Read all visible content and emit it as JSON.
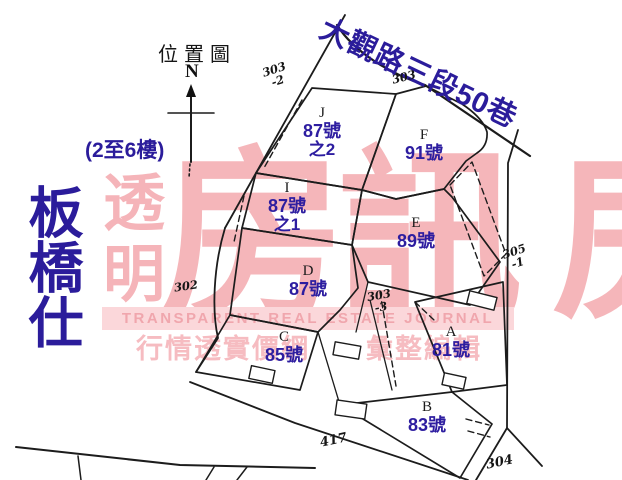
{
  "page": {
    "title": "位置圖",
    "floor_note": "(2至6樓)",
    "area_label": "板橋仕",
    "street_name": "大觀路三段50巷"
  },
  "compass": {
    "north_label": "N"
  },
  "parcels": [
    {
      "letter": "J",
      "number": "87號",
      "suffix": "之2"
    },
    {
      "letter": "F",
      "number": "91號",
      "suffix": ""
    },
    {
      "letter": "I",
      "number": "87號",
      "suffix": "之1"
    },
    {
      "letter": "E",
      "number": "89號",
      "suffix": ""
    },
    {
      "letter": "D",
      "number": "87號",
      "suffix": ""
    },
    {
      "letter": "C",
      "number": "85號",
      "suffix": ""
    },
    {
      "letter": "A",
      "number": "81號",
      "suffix": ""
    },
    {
      "letter": "B",
      "number": "83號",
      "suffix": ""
    }
  ],
  "lots": [
    {
      "line1": "303",
      "line2": "-2"
    },
    {
      "line1": "303",
      "line2": ""
    },
    {
      "line1": "302",
      "line2": ""
    },
    {
      "line1": "303",
      "line2": "-3"
    },
    {
      "line1": "305",
      "line2": "-1"
    },
    {
      "line1": "417",
      "line2": ""
    },
    {
      "line1": "304",
      "line2": ""
    }
  ],
  "watermark": {
    "vertical_text": "透明",
    "big_text": "房訊",
    "band_text": "TRANSPARENT REAL ESTATE JOURNAL",
    "slogan_left": "行情透實價網",
    "slogan_right": "彙整編輯",
    "colors": {
      "pink": "#f5b6ba",
      "band_bg": "#fbd7da",
      "band_text": "#f0a6ad"
    }
  },
  "colors": {
    "title_blue": "#2b1c9b",
    "label_blue": "#2d1da0",
    "line_black": "#1c1c1c"
  }
}
